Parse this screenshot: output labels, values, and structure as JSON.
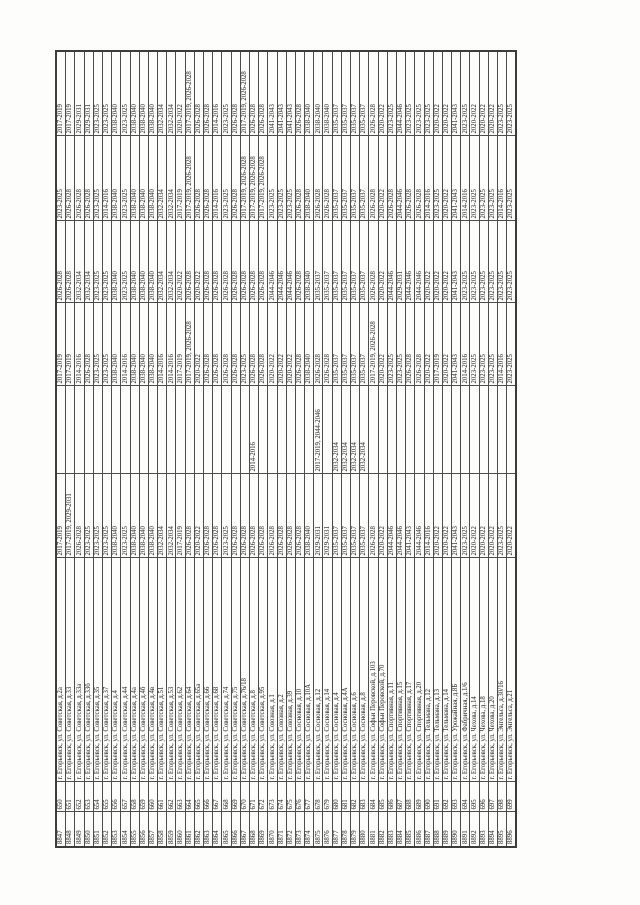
{
  "page": {
    "background": "#fdfdfc"
  },
  "table": {
    "rotation_deg": -90,
    "border_color": "#4d4d4d",
    "text_color": "#222222",
    "column_names": [
      "row-number-cell",
      "item-number-cell",
      "address-cell",
      "period-cell-1",
      "period-cell-2",
      "period-cell-3",
      "period-cell-4",
      "period-cell-5",
      "period-cell-6"
    ],
    "rows": [
      [
        "8847",
        "650",
        "г. Егорьевск, ул. Советская, д.2а",
        "2017-2019",
        "",
        "2017-2019",
        "2026-2028",
        "2023-2025",
        "2017-2019"
      ],
      [
        "8848",
        "651",
        "г. Егорьевск, ул. Советская, д.33",
        "2017-2019, 2029-2031",
        "",
        "2017-2019",
        "2026-2028",
        "2026-2028",
        "2017-2019"
      ],
      [
        "8849",
        "652",
        "г. Егорьевск, ул. Советская, д.33а",
        "2026-2028",
        "",
        "2014-2016",
        "2032-2034",
        "2026-2028",
        "2029-2031"
      ],
      [
        "8850",
        "653",
        "г. Егорьевск, ул. Советская, д.33б",
        "2023-2025",
        "",
        "2026-2028",
        "2032-2034",
        "2026-2028",
        "2029-2031"
      ],
      [
        "8851",
        "654",
        "г. Егорьевск, ул. Советская, д.35",
        "2023-2025",
        "",
        "2023-2025",
        "2023-2025",
        "2023-2025",
        "2023-2025"
      ],
      [
        "8852",
        "655",
        "г. Егорьевск, ул. Советская, д.37",
        "2023-2025",
        "",
        "2023-2025",
        "2023-2025",
        "2014-2016",
        "2023-2025"
      ],
      [
        "8853",
        "656",
        "г. Егорьевск, ул. Советская, д.4",
        "2038-2040",
        "",
        "2038-2040",
        "2038-2040",
        "2038-2040",
        "2038-2040"
      ],
      [
        "8854",
        "657",
        "г. Егорьевск, ул. Советская, д.44",
        "2023-2025",
        "",
        "2014-2016",
        "2023-2025",
        "2023-2025",
        "2023-2025"
      ],
      [
        "8855",
        "658",
        "г. Егорьевск, ул. Советская, д.4а",
        "2038-2040",
        "",
        "2038-2040",
        "2038-2040",
        "2038-2040",
        "2038-2040"
      ],
      [
        "8856",
        "659",
        "г. Егорьевск, ул. Советская, д.4б",
        "2038-2040",
        "",
        "2038-2040",
        "2038-2040",
        "2038-2040",
        "2038-2040"
      ],
      [
        "8857",
        "660",
        "г. Егорьевск, ул. Советская, д.4в",
        "2038-2040",
        "",
        "2038-2040",
        "2038-2040",
        "2038-2040",
        "2038-2040"
      ],
      [
        "8858",
        "661",
        "г. Егорьевск, ул. Советская, д.51",
        "2032-2034",
        "",
        "2014-2016",
        "2032-2034",
        "2032-2034",
        "2032-2034"
      ],
      [
        "8859",
        "662",
        "г. Егорьевск, ул. Советская, д.53",
        "2032-2034",
        "",
        "2014-2016",
        "2032-2034",
        "2032-2034",
        "2032-2034"
      ],
      [
        "8860",
        "663",
        "г. Егорьевск, ул. Советская, д.62",
        "2017-2019",
        "",
        "2017-2019",
        "2020-2022",
        "2017-2019",
        "2020-2022"
      ],
      [
        "8861",
        "664",
        "г. Егорьевск, ул. Советская, д.64",
        "2026-2028",
        "",
        "2017-2019, 2026-2028",
        "2026-2028",
        "2017-2019, 2026-2028",
        "2017-2019, 2026-2028"
      ],
      [
        "8862",
        "665",
        "г. Егорьевск, ул. Советская, д.65а",
        "2020-2022",
        "",
        "2020-2022",
        "2020-2022",
        "2026-2028",
        "2026-2028"
      ],
      [
        "8863",
        "666",
        "г. Егорьевск, ул. Советская, д.66",
        "2026-2028",
        "",
        "2026-2028",
        "2026-2028",
        "2026-2028",
        "2026-2028"
      ],
      [
        "8864",
        "667",
        "г. Егорьевск, ул. Советская, д.68",
        "2026-2028",
        "",
        "2026-2028",
        "2026-2028",
        "2014-2016",
        "2014-2016"
      ],
      [
        "8865",
        "668",
        "г. Егорьевск, ул. Советская, д.74",
        "2023-2025",
        "",
        "2026-2028",
        "2026-2028",
        "2023-2025",
        "2023-2025"
      ],
      [
        "8866",
        "669",
        "г. Егорьевск, ул. Советская, д.75",
        "2026-2028",
        "",
        "2026-2028",
        "2026-2028",
        "2026-2028",
        "2026-2028"
      ],
      [
        "8867",
        "670",
        "г. Егорьевск, ул. Советская, д.76/18",
        "2026-2028",
        "",
        "2023-2025",
        "2026-2028",
        "2017-2019, 2026-2028",
        "2017-2019, 2026-2028"
      ],
      [
        "8868",
        "671",
        "г. Егорьевск, ул. Советская, д.8",
        "2026-2028",
        "2014-2016",
        "2026-2028",
        "2026-2028",
        "2017-2019, 2026-2028",
        "2026-2028"
      ],
      [
        "8869",
        "672",
        "г. Егорьевск, ул. Советская, д.95",
        "2026-2028",
        "",
        "2026-2028",
        "2026-2028",
        "2017-2019, 2026-2028",
        "2026-2028"
      ],
      [
        "8870",
        "673",
        "г. Егорьевск, ул. Союзная, д.1",
        "2026-2028",
        "",
        "2020-2022",
        "2044-2046",
        "2023-2025",
        "2041-2043"
      ],
      [
        "8871",
        "674",
        "г. Егорьевск, ул. Союзная, д.2",
        "2026-2028",
        "",
        "2020-2022",
        "2044-2046",
        "2023-2025",
        "2041-2043"
      ],
      [
        "8872",
        "675",
        "г. Егорьевск, ул. Союзная, д.39",
        "2026-2028",
        "",
        "2020-2022",
        "2044-2046",
        "2023-2025",
        "2041-2043"
      ],
      [
        "8873",
        "676",
        "г. Егорьевск, ул. Сосновая, д.10",
        "2026-2028",
        "",
        "2026-2028",
        "2026-2028",
        "2026-2028",
        "2026-2028"
      ],
      [
        "8874",
        "677",
        "г. Егорьевск, ул. Сосновая, д.10А",
        "2038-2040",
        "",
        "2038-2040",
        "2038-2040",
        "2038-2040",
        "2038-2040"
      ],
      [
        "8875",
        "678",
        "г. Егорьевск, ул. Сосновая, д.12",
        "2029-2031",
        "2017-2019, 2044-2046",
        "2026-2028",
        "2035-2037",
        "2026-2028",
        "2038-2040"
      ],
      [
        "8876",
        "679",
        "г. Егорьевск, ул. Сосновая, д.14",
        "2029-2031",
        "",
        "2026-2028",
        "2035-2037",
        "2026-2028",
        "2038-2040"
      ],
      [
        "8877",
        "680",
        "г. Егорьевск, ул. Сосновая, д.4",
        "2035-2037",
        "2032-2034",
        "2035-2037",
        "2035-2037",
        "2035-2037",
        "2035-2037"
      ],
      [
        "8878",
        "681",
        "г. Егорьевск, ул. Сосновая, д.4А",
        "2035-2037",
        "2032-2034",
        "2035-2037",
        "2035-2037",
        "2035-2037",
        "2035-2037"
      ],
      [
        "8879",
        "682",
        "г. Егорьевск, ул. Сосновая, д.6",
        "2035-2037",
        "2032-2034",
        "2035-2037",
        "2035-2037",
        "2035-2037",
        "2035-2037"
      ],
      [
        "8880",
        "683",
        "г. Егорьевск, ул. Сосновая, д.8",
        "2035-2037",
        "2032-2034",
        "2035-2037",
        "2035-2037",
        "2035-2037",
        "2035-2037"
      ],
      [
        "8881",
        "684",
        "г. Егорьевск, ул. Софьи Перовской, д.103",
        "2026-2028",
        "",
        "2017-2019, 2026-2028",
        "2026-2028",
        "2026-2028",
        "2026-2028"
      ],
      [
        "8882",
        "685",
        "г. Егорьевск, ул. Софьи Перовской, д.70",
        "2020-2022",
        "",
        "2020-2022",
        "2020-2022",
        "2020-2022",
        "2020-2022"
      ],
      [
        "8883",
        "686",
        "г. Егорьевск, ул. Спортивная, д.11",
        "2044-2046",
        "",
        "2023-2025",
        "2044-2046",
        "2026-2028",
        "2023-2025"
      ],
      [
        "8884",
        "687",
        "г. Егорьевск, ул. Спортивная, д.15",
        "2044-2046",
        "",
        "2023-2025",
        "2029-2031",
        "2044-2046",
        "2044-2046"
      ],
      [
        "8885",
        "688",
        "г. Егорьевск, ул. Спортивная, д.17",
        "2041-2043",
        "",
        "2026-2028",
        "2044-2046",
        "2026-2028",
        "2023-2025"
      ],
      [
        "8886",
        "689",
        "г. Егорьевск, ул. Спортивная, д.20",
        "2044-2046",
        "",
        "2026-2028",
        "2044-2046",
        "2026-2028",
        "2023-2025"
      ],
      [
        "8887",
        "690",
        "г. Егорьевск, ул. Тельмана, д.12",
        "2014-2016",
        "",
        "2020-2022",
        "2020-2022",
        "2014-2016",
        "2023-2025"
      ],
      [
        "8888",
        "691",
        "г. Егорьевск, ул. Тельмана, д.13",
        "2020-2022",
        "",
        "2017-2019",
        "2020-2022",
        "2023-2025",
        "2020-2022"
      ],
      [
        "8889",
        "692",
        "г. Егорьевск, ул. Тельмана, д.14",
        "2020-2022",
        "",
        "2020-2022",
        "2020-2022",
        "2020-2022",
        "2020-2022"
      ],
      [
        "8890",
        "693",
        "г. Егорьевск, ул. Урожайная, д.8Б",
        "2041-2043",
        "",
        "2041-2043",
        "2041-2043",
        "2041-2043",
        "2041-2043"
      ],
      [
        "8891",
        "694",
        "г. Егорьевск, ул. Фабричная, д.1/6",
        "2023-2025",
        "",
        "2014-2016",
        "2023-2025",
        "2014-2016",
        "2023-2025"
      ],
      [
        "8892",
        "695",
        "г. Егорьевск, ул. Чехова, д.14",
        "2020-2022",
        "",
        "2023-2025",
        "2023-2025",
        "2023-2025",
        "2020-2022"
      ],
      [
        "8893",
        "696",
        "г. Егорьевск, ул. Чехова, д.18",
        "2020-2022",
        "",
        "2023-2025",
        "2023-2025",
        "2023-2025",
        "2020-2022"
      ],
      [
        "8894",
        "697",
        "г. Егорьевск, ул. Чехова, д.20",
        "2020-2022",
        "",
        "2023-2025",
        "2023-2025",
        "2023-2025",
        "2020-2022"
      ],
      [
        "8895",
        "698",
        "г. Егорьевск, ул. Энгельса, д.30/16",
        "2023-2025",
        "",
        "2014-2016",
        "2023-2025",
        "2014-2016",
        "2023-2025"
      ],
      [
        "8896",
        "699",
        "г. Егорьевск, ул. Энгельса, д.21",
        "2020-2022",
        "",
        "2023-2025",
        "2023-2025",
        "2023-2025",
        "2023-2025"
      ]
    ]
  }
}
